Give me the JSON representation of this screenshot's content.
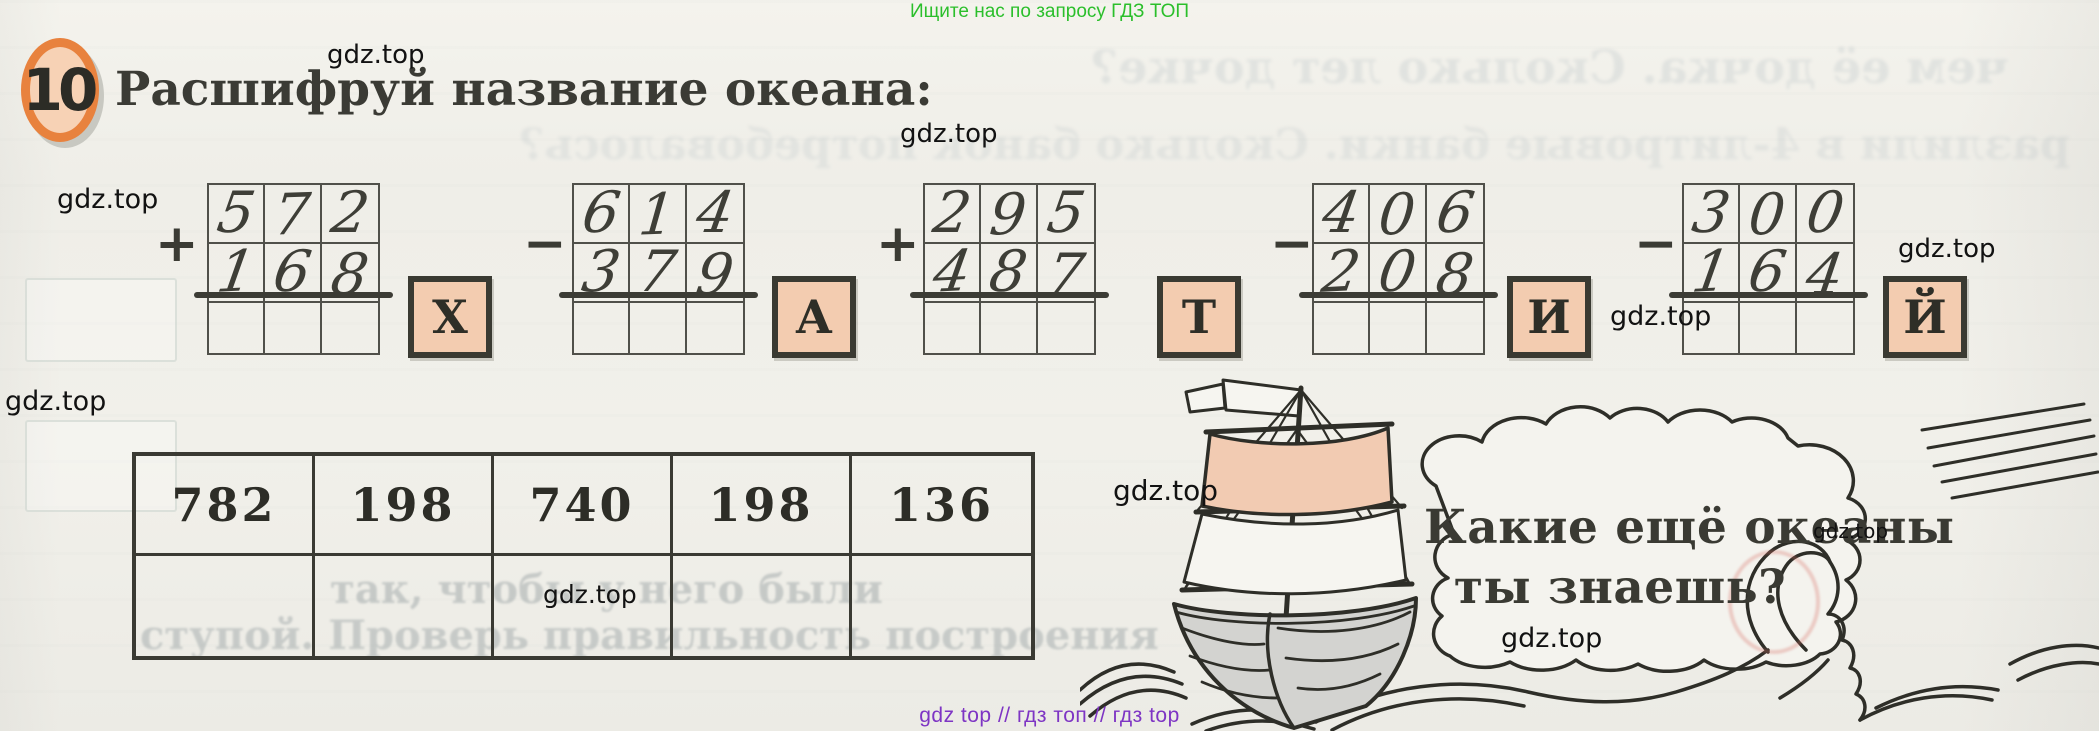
{
  "site": {
    "top_banner": "Ищите нас по запросу ГДЗ ТОП",
    "bottom_banner": "gdz top  //  гдз топ  //  гдз top",
    "watermark": "gdz.top"
  },
  "task": {
    "number": "10",
    "title": "Расшифруй название океана:"
  },
  "problems": [
    {
      "operator": "+",
      "top": [
        "5",
        "7",
        "2"
      ],
      "bottom": [
        "1",
        "6",
        "8"
      ],
      "letter": "Х"
    },
    {
      "operator": "−",
      "top": [
        "6",
        "1",
        "4"
      ],
      "bottom": [
        "3",
        "7",
        "9"
      ],
      "letter": "А"
    },
    {
      "operator": "+",
      "top": [
        "2",
        "9",
        "5"
      ],
      "bottom": [
        "4",
        "8",
        "7"
      ],
      "letter": "Т"
    },
    {
      "operator": "−",
      "top": [
        "4",
        "0",
        "6"
      ],
      "bottom": [
        "2",
        "0",
        "8"
      ],
      "letter": "И"
    },
    {
      "operator": "−",
      "top": [
        "3",
        "0",
        "0"
      ],
      "bottom": [
        "1",
        "6",
        "4"
      ],
      "letter": "Й"
    }
  ],
  "answer_table": {
    "numbers": [
      "782",
      "198",
      "740",
      "198",
      "136"
    ]
  },
  "speech_bubble": {
    "line1": "Какие ещё океаны",
    "line2": "ты знаешь?"
  },
  "bleed_through": {
    "mirrored_top_1": "чем её дочка. Сколько лет дочке?",
    "mirrored_top_2": "разлили в 4-литровые банки. Сколько банок потребовалось?",
    "overlay_row_1": "так, чтобы у него были",
    "overlay_row_2": "ступой. Проверь правильность построения"
  },
  "colors": {
    "accent_orange": "#e8823e",
    "peach_fill": "#f3ccb0",
    "banner_green": "#2bbf2b",
    "banner_purple": "#7e35c4",
    "ink": "#33332c"
  }
}
